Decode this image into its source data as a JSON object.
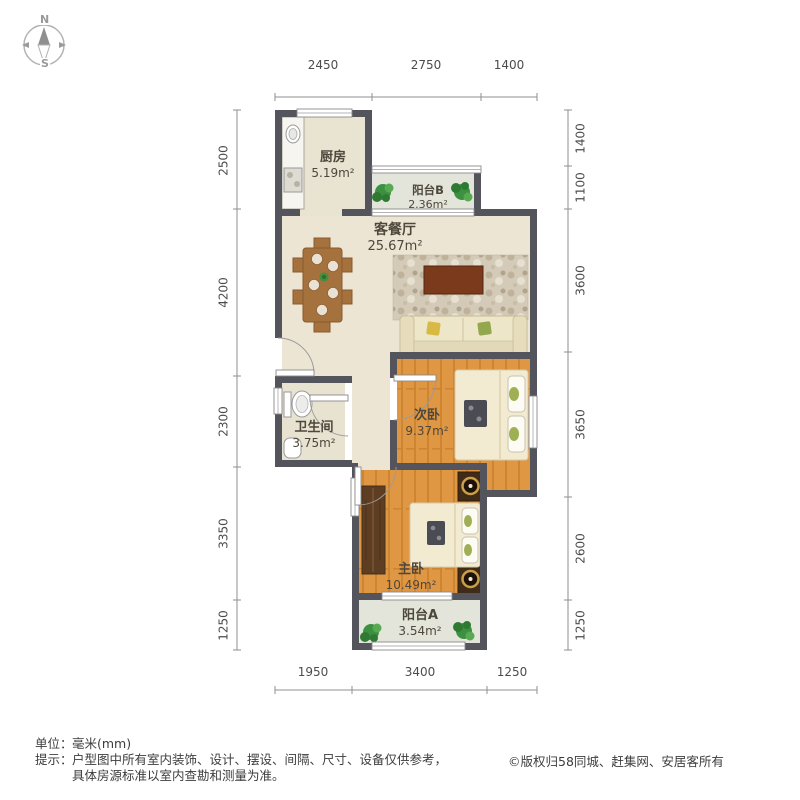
{
  "compass": {
    "north": "N",
    "south": "S"
  },
  "plan": {
    "rooms": [
      {
        "id": "kitchen",
        "name": "厨房",
        "area": "5.19m²"
      },
      {
        "id": "balcony-b",
        "name": "阳台B",
        "area": "2.36m²"
      },
      {
        "id": "living-dining",
        "name": "客餐厅",
        "area": "25.67m²"
      },
      {
        "id": "bathroom",
        "name": "卫生间",
        "area": "3.75m²"
      },
      {
        "id": "bedroom-second",
        "name": "次卧",
        "area": "9.37m²"
      },
      {
        "id": "bedroom-master",
        "name": "主卧",
        "area": "10.49m²"
      },
      {
        "id": "balcony-a",
        "name": "阳台A",
        "area": "3.54m²"
      }
    ],
    "dimensions": {
      "top": [
        "2450",
        "2750",
        "1400"
      ],
      "bottom": [
        "1950",
        "3400",
        "1250"
      ],
      "left": [
        "2500",
        "4200",
        "2300",
        "3350",
        "1250"
      ],
      "right": [
        "1400",
        "1100",
        "3600",
        "3650",
        "2600",
        "1250"
      ]
    }
  },
  "footer": {
    "unit_label": "单位：",
    "unit_value": "毫米(mm)",
    "tip_label": "提示：",
    "tip_line1": "户型图中所有室内装饰、设计、摆设、间隔、尺寸、设备仅供参考，",
    "tip_line2": "具体房源标准以室内查勘和测量为准。",
    "copyright": "©版权归58同城、赶集网、安居客所有"
  },
  "colors": {
    "wall": "#54545c",
    "floor_beige": "#ece5d3",
    "floor_wood": "#e09743",
    "floor_balcony": "#e3e4da",
    "plant_green": "#3c9140",
    "tv_brown": "#7c3a1c"
  }
}
